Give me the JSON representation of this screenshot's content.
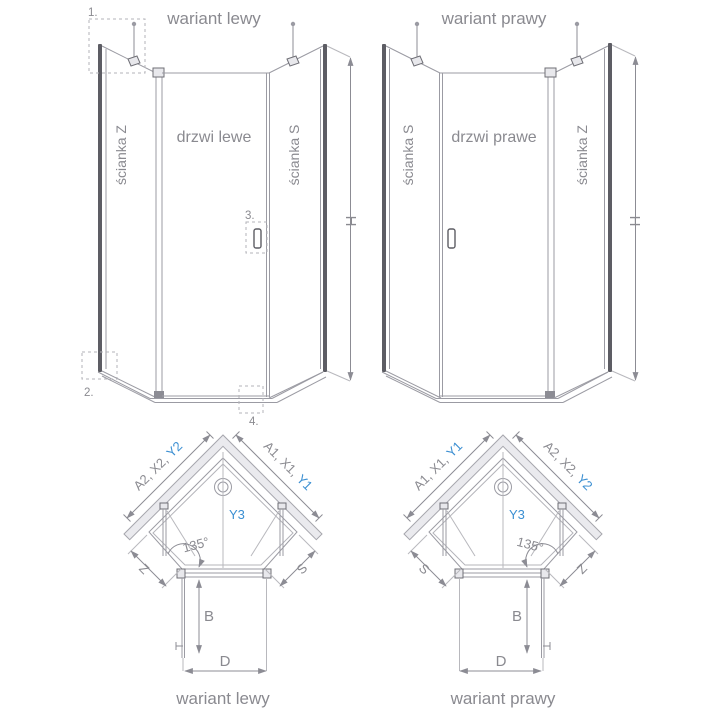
{
  "figures": {
    "elevation_left": {
      "title": "wariant lewy",
      "wall_left": "ścianka Z",
      "door": "drzwi lewe",
      "wall_right": "ścianka S",
      "height_label": "H",
      "callout_1": "1.",
      "callout_2": "2.",
      "callout_3": "3.",
      "callout_4": "4."
    },
    "elevation_right": {
      "title": "wariant prawy",
      "wall_left": "ścianka S",
      "door": "drzwi prawe",
      "wall_right": "ścianka Z",
      "height_label": "H"
    },
    "plan_left": {
      "title": "wariant lewy",
      "dim_left_gray": "A2, X2,",
      "dim_left_blue": "Y2",
      "dim_right_gray": "A1, X1,",
      "dim_right_blue": "Y1",
      "center_blue": "Y3",
      "angle": "135°",
      "edge_left": "Z",
      "edge_right": "S",
      "depth": "B",
      "width": "D"
    },
    "plan_right": {
      "title": "wariant prawy",
      "dim_left_gray": "A1, X1,",
      "dim_left_blue": "Y1",
      "dim_right_gray": "A2, X2,",
      "dim_right_blue": "Y2",
      "center_blue": "Y3",
      "angle": "135°",
      "edge_left": "S",
      "edge_right": "Z",
      "depth": "B",
      "width": "D"
    }
  },
  "colors": {
    "line_gray": "#9b9ba3",
    "profile_dark": "#5d5d64",
    "text_gray": "#8a8a90",
    "accent_blue": "#3b8fd2",
    "wall_band_fill": "#eaeaee"
  }
}
